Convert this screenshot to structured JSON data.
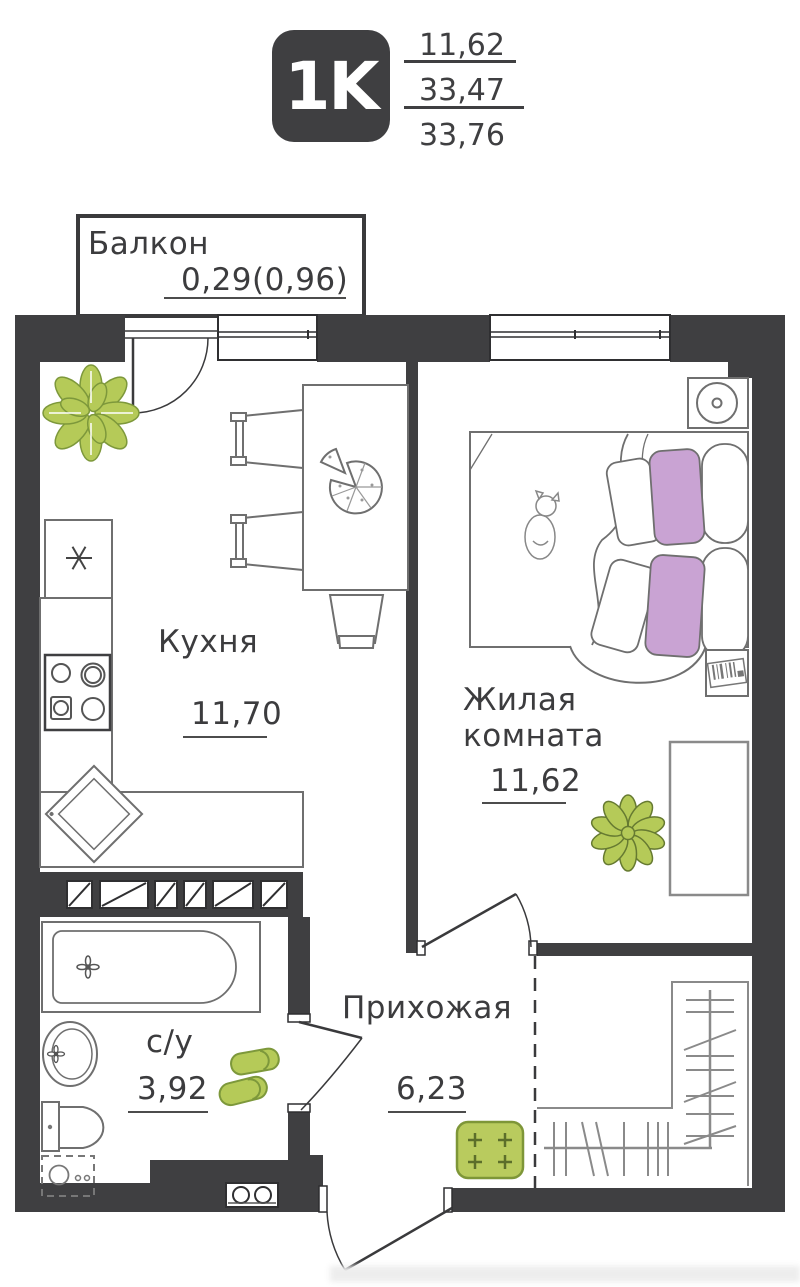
{
  "header": {
    "type_badge": "1K",
    "areas": {
      "living_area": "11,62",
      "total_area": "33,47",
      "total_area_with_balcony": "33,76"
    }
  },
  "rooms": {
    "balcony": {
      "label": "Балкон",
      "area": "0,29(0,96)"
    },
    "kitchen": {
      "label": "Кухня",
      "area": "11,70"
    },
    "living_room": {
      "label": "Жилая комната",
      "area": "11,62"
    },
    "hallway": {
      "label": "Прихожая",
      "area": "6,23"
    },
    "bathroom": {
      "label": "с/у",
      "area": "3,92"
    }
  },
  "icons": {
    "fridge_snowflake": "✳",
    "plant": "green-plant",
    "pizza": "pizza-on-table",
    "pouf": "green-flower-pouf",
    "slippers": "green-slippers",
    "doormat": "green-doormat-with-plus-marks"
  },
  "colors": {
    "wall": "#3f3f41",
    "furniture_outline": "#6f6f6f",
    "accent_green": "#b5ca58",
    "accent_purple": "#c9a3d3"
  }
}
